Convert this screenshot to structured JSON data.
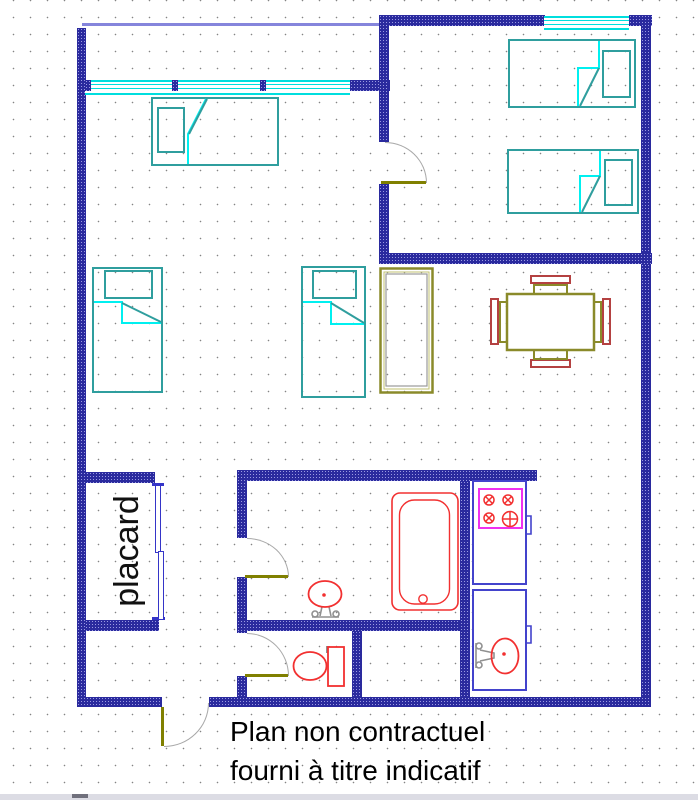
{
  "page": {
    "type": "apartment-floor-plan"
  },
  "labels": {
    "closet": "placard",
    "disclaimer_line1": "Plan non contractuel",
    "disclaimer_line2": "fourni à titre indicatif"
  },
  "palette": {
    "wall": "#2a2a9e",
    "wall_speckle": "#9a9ae2",
    "window_cyan": "#00dede",
    "balcony_line_purple": "#8585dc",
    "bed_teal": "#2f9e9e",
    "fold_cyan": "#00f0f0",
    "sanitary_red": "#f23030",
    "kitchen_blue": "#4343cc",
    "cooktop_magenta": "#f030f0",
    "wood_olive": "#8a8a2a",
    "chair_red": "#b44141",
    "door_leaf_olive": "#808000",
    "door_swing_gray": "#a8a8a8",
    "closet_door_blue": "#3535c8",
    "faucet_gray": "#909090",
    "text_black": "#111111"
  },
  "furniture": {
    "living_room": [
      "single-bed",
      "single-bed",
      "single-bed",
      "wardrobe",
      "dining-table-with-4-chairs"
    ],
    "bedroom": [
      "single-bed",
      "single-bed"
    ],
    "bathroom": [
      "bathtub",
      "washbasin"
    ],
    "wc": [
      "toilet"
    ],
    "kitchen": [
      "cooktop-unit",
      "sink-unit"
    ],
    "closet": [
      "sliding-doors"
    ]
  }
}
